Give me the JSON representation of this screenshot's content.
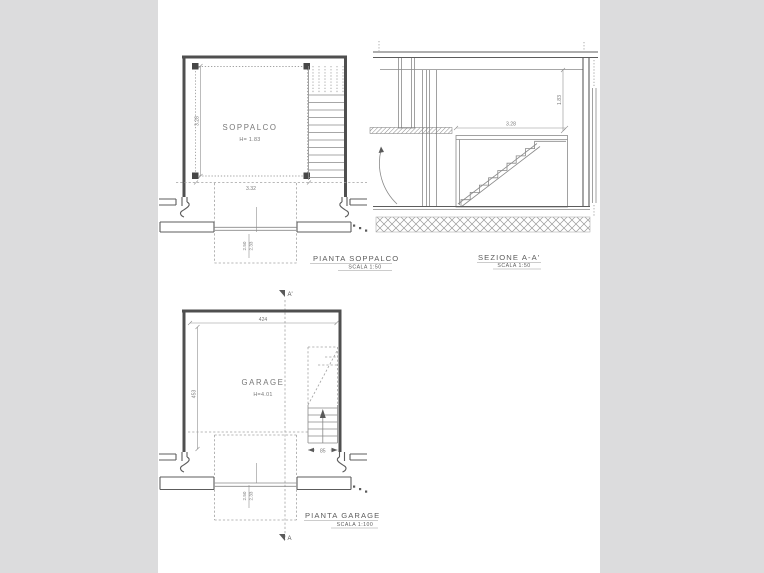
{
  "page": {
    "background_color": "#dcdcdd",
    "sheet_color": "#ffffff",
    "line_color": "#4f4f4f"
  },
  "soppalco_plan": {
    "title": "PIANTA SOPPALCO",
    "scale": "SCALA 1:50",
    "room_label": "SOPPALCO",
    "room_height": "H= 1.83",
    "dim_depth": "3.28",
    "dim_width": "3.32",
    "dim_opening_upper": "2.50",
    "dim_opening_lower": "2.33"
  },
  "section": {
    "title": "SEZIONE A-A'",
    "scale": "SCALA 1:50",
    "dim_width": "3.28",
    "dim_height": "1.83"
  },
  "garage_plan": {
    "title": "PIANTA GARAGE",
    "scale": "SCALA 1:100",
    "room_label": "GARAGE",
    "room_height": "H=4.01",
    "dim_width": "424",
    "dim_depth": "453",
    "dim_stair_width": "85",
    "dim_opening_upper": "2.50",
    "dim_opening_lower": "2.33",
    "section_marker_top": "A'",
    "section_marker_bottom": "A"
  }
}
